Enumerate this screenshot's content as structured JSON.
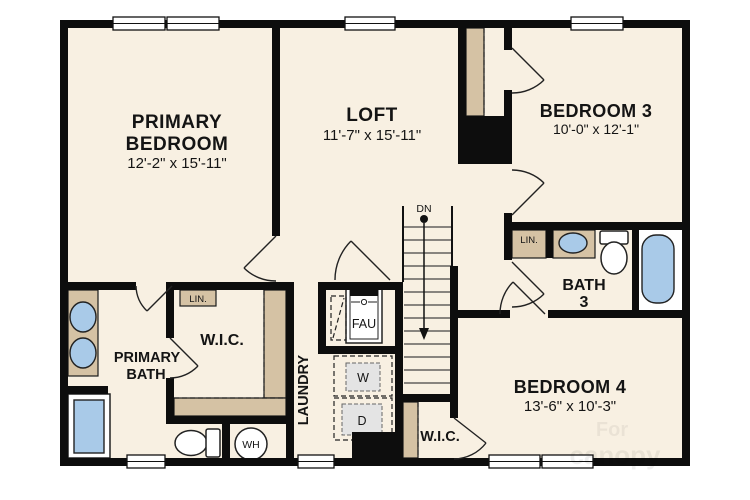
{
  "rooms": {
    "primary_bedroom": {
      "name_lines": [
        "PRIMARY",
        "BEDROOM"
      ],
      "dims": "12'-2\" x 15'-11\""
    },
    "loft": {
      "name": "LOFT",
      "dims": "11'-7\" x 15'-11\""
    },
    "bedroom3": {
      "name": "BEDROOM 3",
      "dims": "10'-0\" x 12'-1\""
    },
    "bath3": {
      "name_lines": [
        "BATH",
        "3"
      ]
    },
    "primary_bath": {
      "name_lines": [
        "PRIMARY",
        "BATH"
      ]
    },
    "primary_wic": {
      "name": "W.I.C."
    },
    "laundry": {
      "name": "LAUNDRY"
    },
    "bedroom4": {
      "name": "BEDROOM 4",
      "dims": "13'-6\" x 10'-3\""
    },
    "bedroom4_wic": {
      "name": "W.I.C."
    }
  },
  "annotations": {
    "stairs_direction": "DN",
    "furnace": "FAU",
    "washer": "W",
    "dryer": "D",
    "water_heater": "WH",
    "linen_primary": "LIN.",
    "linen_bath3": "LIN."
  },
  "watermark": {
    "line1": "For",
    "line2": "canopy"
  },
  "colors": {
    "floor": "#f8f0e2",
    "wall": "#0d0d0d",
    "counter_tan": "#d5c2a4",
    "fixture_blue": "#a9cae8",
    "appliance_gray": "#e4e4e4"
  }
}
